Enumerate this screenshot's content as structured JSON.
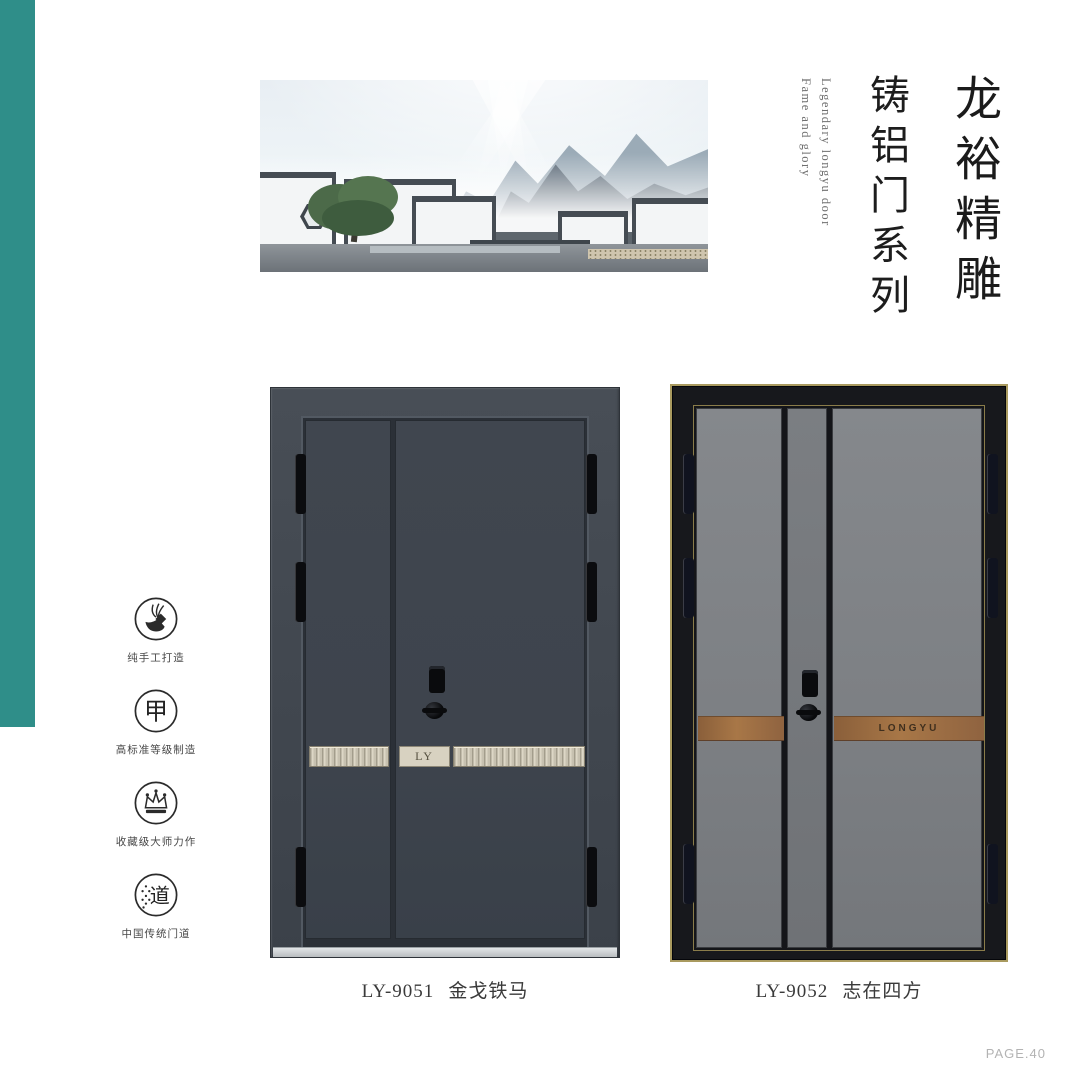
{
  "page": {
    "page_number": "PAGE.40"
  },
  "title": {
    "main": "龙裕精雕",
    "sub": "铸铝门系列",
    "english": [
      "Fame and glory",
      "Legendary longyu door"
    ]
  },
  "features": [
    {
      "icon": "hand-craft-icon",
      "label": "纯手工打造"
    },
    {
      "icon": "jia-grade-icon",
      "glyph": "甲",
      "label": "高标准等级制造"
    },
    {
      "icon": "crown-icon",
      "label": "收藏级大师力作"
    },
    {
      "icon": "dao-tradition-icon",
      "glyph": "道",
      "label": "中国传统门道"
    }
  ],
  "products": [
    {
      "model": "LY-9051",
      "name": "金戈铁马",
      "badge": "LY"
    },
    {
      "model": "LY-9052",
      "name": "志在四方",
      "badge": "LONGYU"
    }
  ],
  "colors": {
    "teal": "#2f8e89",
    "door1_panel": "#3e444d",
    "door1_frame": "#434951",
    "champagne": "#d8d2c1",
    "door2_frame": "#17181c",
    "door2_panel": "#7d8084",
    "copper": "#9c6b42",
    "gold_trim": "#a99a5f"
  }
}
